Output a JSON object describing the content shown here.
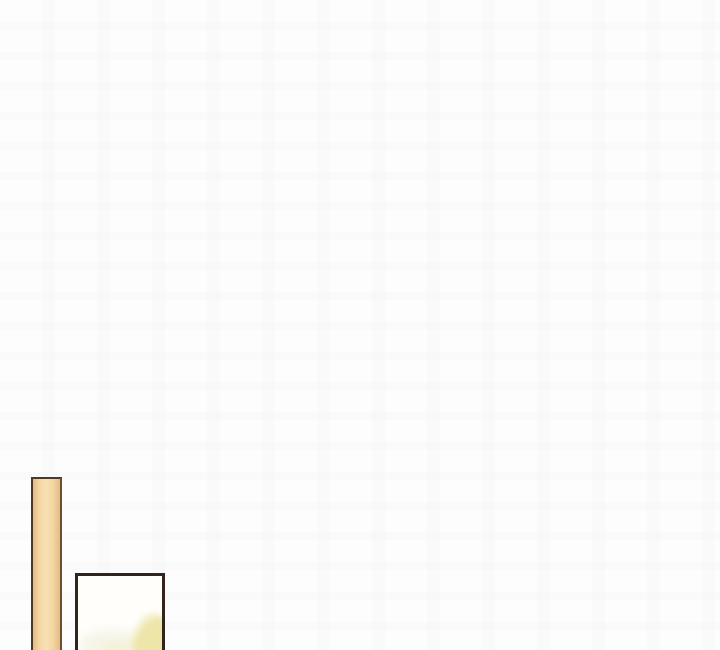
{
  "scene": {
    "type": "comic-panel",
    "plank_label": "wooden-plank",
    "frame_label": "picture-frame"
  },
  "colors": {
    "canvas-bg": "#fdfdfd",
    "ghost-mark": "rgba(168,175,182,0.035)",
    "plank-border": "#4e3a24",
    "plank-border-light": "#6d4f2c",
    "plank-fill-dark": "#e3bb84",
    "plank-fill-light": "#f4d8a4",
    "plank-fill-lightest": "#f7e0b4",
    "frame-border": "#33251a",
    "frame-bg": "#fffefb",
    "wash-pale": "#f3f2e2",
    "wash-yellow": "#eee5a9",
    "wash-yellow-faint": "#f5f0cd"
  }
}
